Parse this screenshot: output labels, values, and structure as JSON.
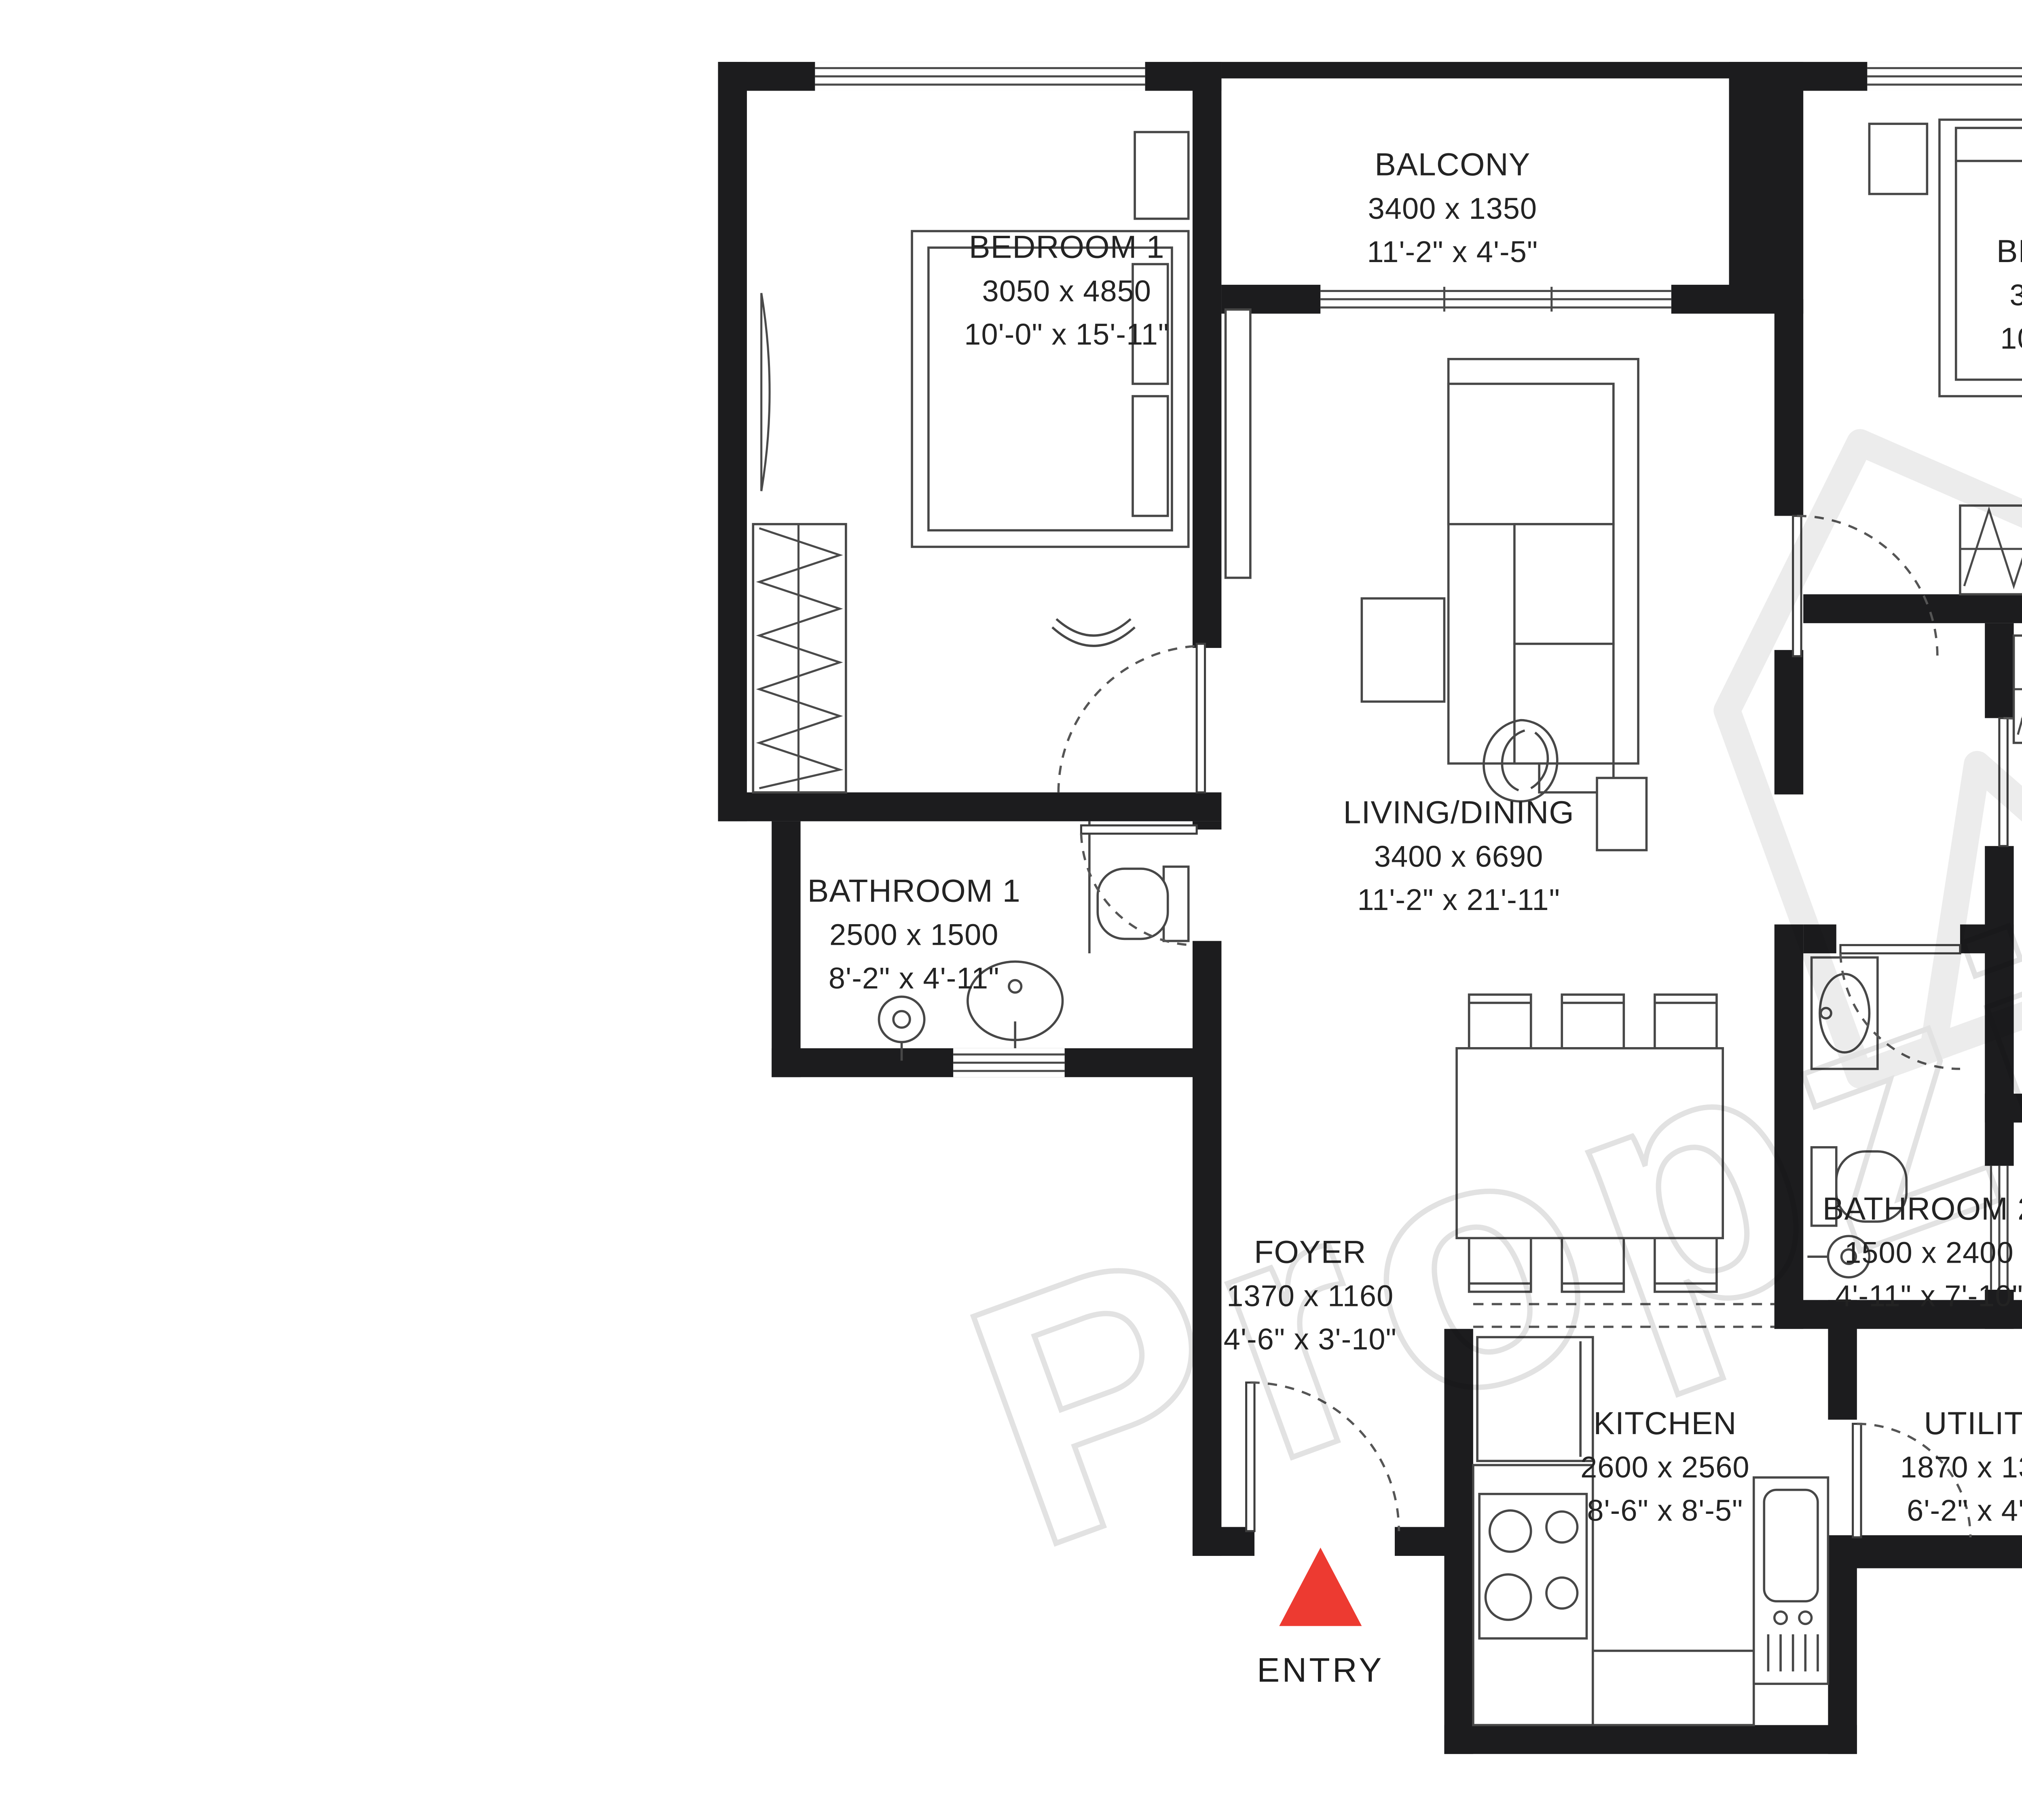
{
  "watermark": {
    "brand": "Propzilla",
    "registered": "®"
  },
  "entry": {
    "label": "ENTRY",
    "marker_color": "#ed3a31"
  },
  "rooms": {
    "bedroom1": {
      "name": "BEDROOM 1",
      "metric": "3050 x 4850",
      "imperial": "10'-0\" x 15'-11\""
    },
    "balcony": {
      "name": "BALCONY",
      "metric": "3400 x 1350",
      "imperial": "11'-2\" x 4'-5\""
    },
    "bedroom2": {
      "name": "BEDROOM 2",
      "metric": "3050 x 3550",
      "imperial": "10'-0\" x 11'-8\""
    },
    "bedroom3": {
      "name": "BEDROOM 3",
      "metric": "3100 x 3050",
      "imperial": "10'-2\" x 10'-0\""
    },
    "living": {
      "name": "LIVING/DINING",
      "metric": "3400 x 6690",
      "imperial": "11'-2\" x 21'-11\""
    },
    "bathroom1": {
      "name": "BATHROOM 1",
      "metric": "2500 x 1500",
      "imperial": "8'-2\" x 4'-11\""
    },
    "bathroom2": {
      "name": "BATHROOM 2",
      "metric": "1500 x 2400",
      "imperial": "4'-11\" x 7'-10\""
    },
    "foyer": {
      "name": "FOYER",
      "metric": "1370 x 1160",
      "imperial": "4'-6\" x 3'-10\""
    },
    "kitchen": {
      "name": "KITCHEN",
      "metric": "2600 x 2560",
      "imperial": "8'-6\" x 8'-5\""
    },
    "utility": {
      "name": "UTILITY",
      "metric": "1870 x 1350",
      "imperial": "6'-2\" x 4'-5\""
    }
  }
}
